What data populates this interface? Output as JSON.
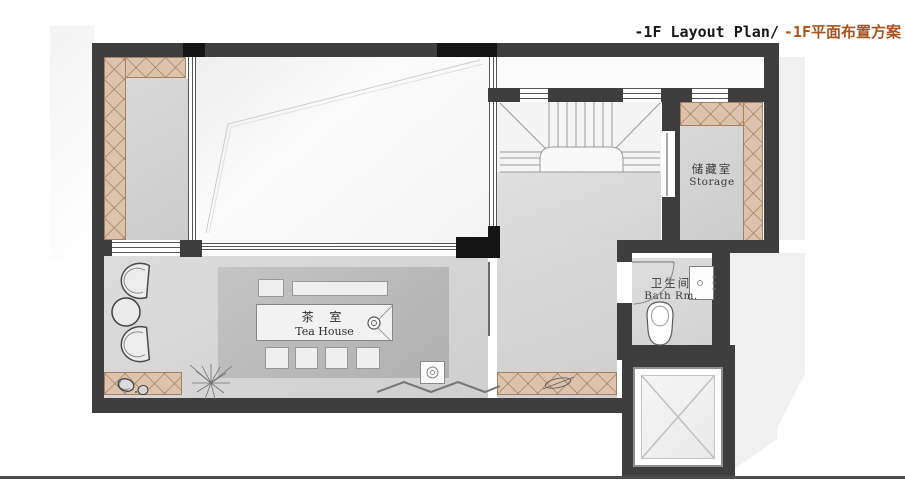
{
  "title": {
    "en": "-1F Layout Plan/",
    "zh": "-1F平面布置方案"
  },
  "rooms": {
    "tea_house": {
      "zh": "茶 室",
      "en": "Tea House"
    },
    "storage": {
      "zh": "储藏室",
      "en": "Storage"
    },
    "bathroom": {
      "zh": "卫生间",
      "en": "Bath Rm."
    }
  },
  "palette": {
    "wall": "#3e3e3e",
    "column_black": "#141414",
    "cabinet_hatch_fill": "#dcc3ab",
    "cabinet_hatch_line": "#a1815f",
    "floor_gray": "#d6d6d6",
    "rug_gray": "#bcbcbc",
    "void_white": "#f6f6f6",
    "title_accent": "#a8541c",
    "shadow": "#f0f0f0"
  }
}
